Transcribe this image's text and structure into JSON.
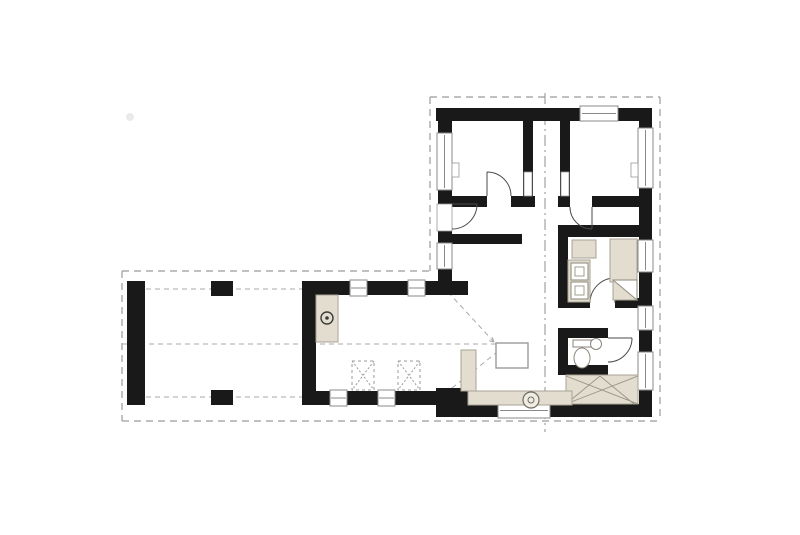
{
  "page": {
    "type": "architectural-floor-plan",
    "background": "#ffffff"
  },
  "colors": {
    "wall": "#191919",
    "fixture_fill": "#e2ddcf",
    "fixture_stroke": "#a9a394",
    "dash_line": "#9b9b9b",
    "section_line": "#8f8f8f",
    "thin_line": "#4a4a4a",
    "window_stroke": "#8a8a8a",
    "floor": "#ffffff"
  },
  "plan": {
    "roof_overhang": "dashed-outline-L-shape",
    "section_marker": "vertical-dash-dot-line",
    "rooms": [
      "bedroom-1",
      "closet",
      "bedroom-2",
      "hallway",
      "bathroom",
      "wc",
      "staircase",
      "living-dining-room",
      "kitchen",
      "covered-terrace-carport"
    ],
    "fixtures": [
      "kitchen-counter-with-cooktop",
      "table-symbol",
      "table-symbol",
      "bath-shelf",
      "bathtub",
      "double-washbasin",
      "shower",
      "toilet",
      "hand-basin",
      "stairs",
      "bench-with-stove",
      "sideboard",
      "chimney"
    ]
  }
}
